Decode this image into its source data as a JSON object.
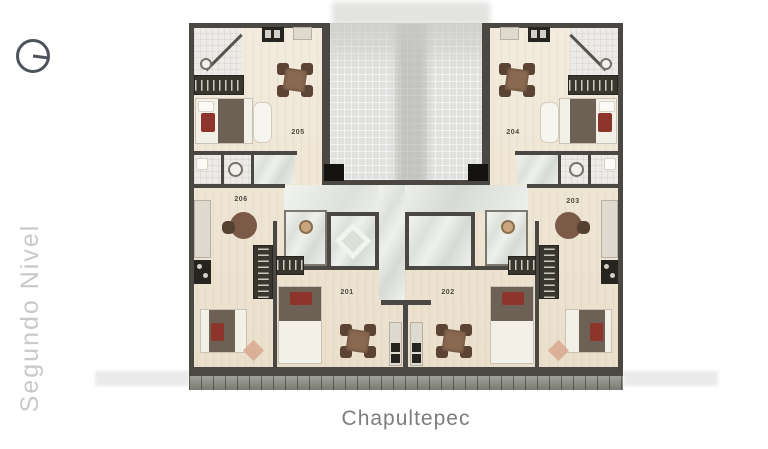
{
  "level": {
    "label": "Segundo Nivel"
  },
  "plan": {
    "title": "Chapultepec",
    "units": [
      {
        "number": "201"
      },
      {
        "number": "202"
      },
      {
        "number": "203"
      },
      {
        "number": "204"
      },
      {
        "number": "205"
      },
      {
        "number": "206"
      }
    ]
  },
  "icons": {
    "compass": "north-orientation-compass"
  },
  "colors": {
    "wall": "#4b4743",
    "floor_wood": "#efe5d3",
    "void_gray": "#e1e1df",
    "marble": "#e8ebe6",
    "tile": "#ecebe7",
    "terrace": "#8e9186",
    "table_brown": "#8a6951",
    "bed_blanket": "#6d6156",
    "accent_red": "#8d342b",
    "closet_dark": "#39362f",
    "title_text": "#7d7d7d",
    "level_text": "#c9c9c9",
    "compass": "#4d525b"
  }
}
